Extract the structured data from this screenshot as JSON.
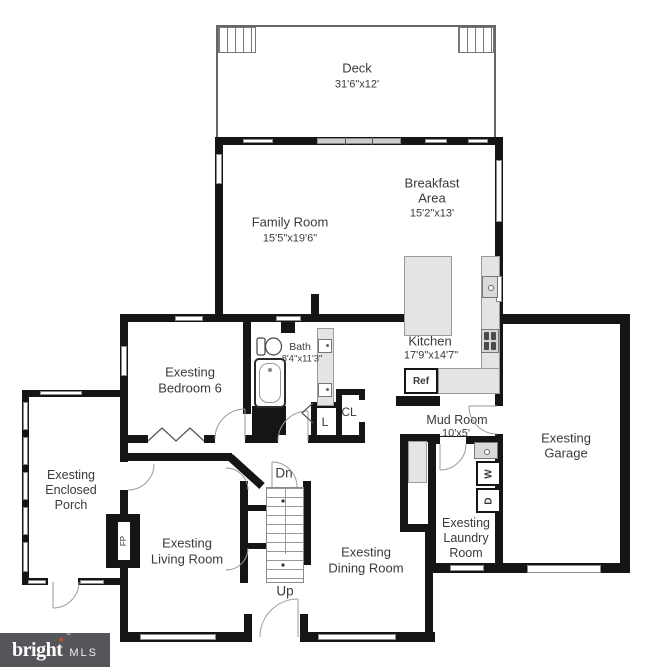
{
  "rooms": {
    "deck": {
      "name": "Deck",
      "dims": "31'6\"x12'"
    },
    "family": {
      "name": "Family Room",
      "dims": "15'5\"x19'6\""
    },
    "breakfast": {
      "line1": "Breakfast",
      "line2": "Area",
      "dims": "15'2\"x13'"
    },
    "kitchen": {
      "name": "Kitchen",
      "dims": "17'9\"x14'7\""
    },
    "bath": {
      "name": "Bath",
      "dims": "8'4\"x11'3\""
    },
    "bedroom": {
      "line1": "Exesting",
      "line2": "Bedroom 6"
    },
    "mudroom": {
      "name": "Mud Room",
      "dims": "10'x5'"
    },
    "garage": {
      "line1": "Exesting",
      "line2": "Garage"
    },
    "porch": {
      "line1": "Exesting",
      "line2": "Enclosed",
      "line3": "Porch"
    },
    "living": {
      "line1": "Exesting",
      "line2": "Living Room"
    },
    "dining": {
      "line1": "Exesting",
      "line2": "Dining Room"
    },
    "laundry": {
      "line1": "Exesting",
      "line2": "Laundry",
      "line3": "Room"
    }
  },
  "fixtures": {
    "stairs_down": "Dn",
    "stairs_up": "Up",
    "linen": "L",
    "closet": "CL",
    "refrigerator": "Ref",
    "fireplace": "FP",
    "washer": "W",
    "dryer": "D"
  },
  "logo": {
    "brand": "bright",
    "suffix": "MLS",
    "tm": "™",
    "star": "✶"
  },
  "colors": {
    "wall": "#151515",
    "counter": "#e4e4e4",
    "counter_border": "#9a9a9a",
    "logo_bg": "#55565a",
    "logo_accent": "#e0521d",
    "ink": "#3a3a3a",
    "thin": "#8a8a8a"
  }
}
